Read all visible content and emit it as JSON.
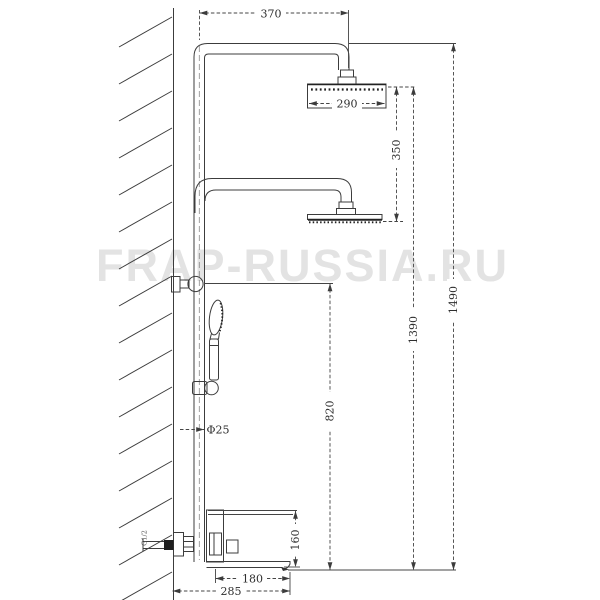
{
  "watermark": {
    "text": "FRAP-RUSSIA.RU"
  },
  "dimensions": {
    "arm_reach": "370",
    "overhead_diameter": "290",
    "between_heads": "350",
    "total_height": "1490",
    "overhead_height": "1390",
    "bar_height": "820",
    "pipe_diameter": "Φ25",
    "spout_height": "160",
    "spout_reach": "180",
    "overall_depth": "285",
    "thread": "G1/2"
  }
}
